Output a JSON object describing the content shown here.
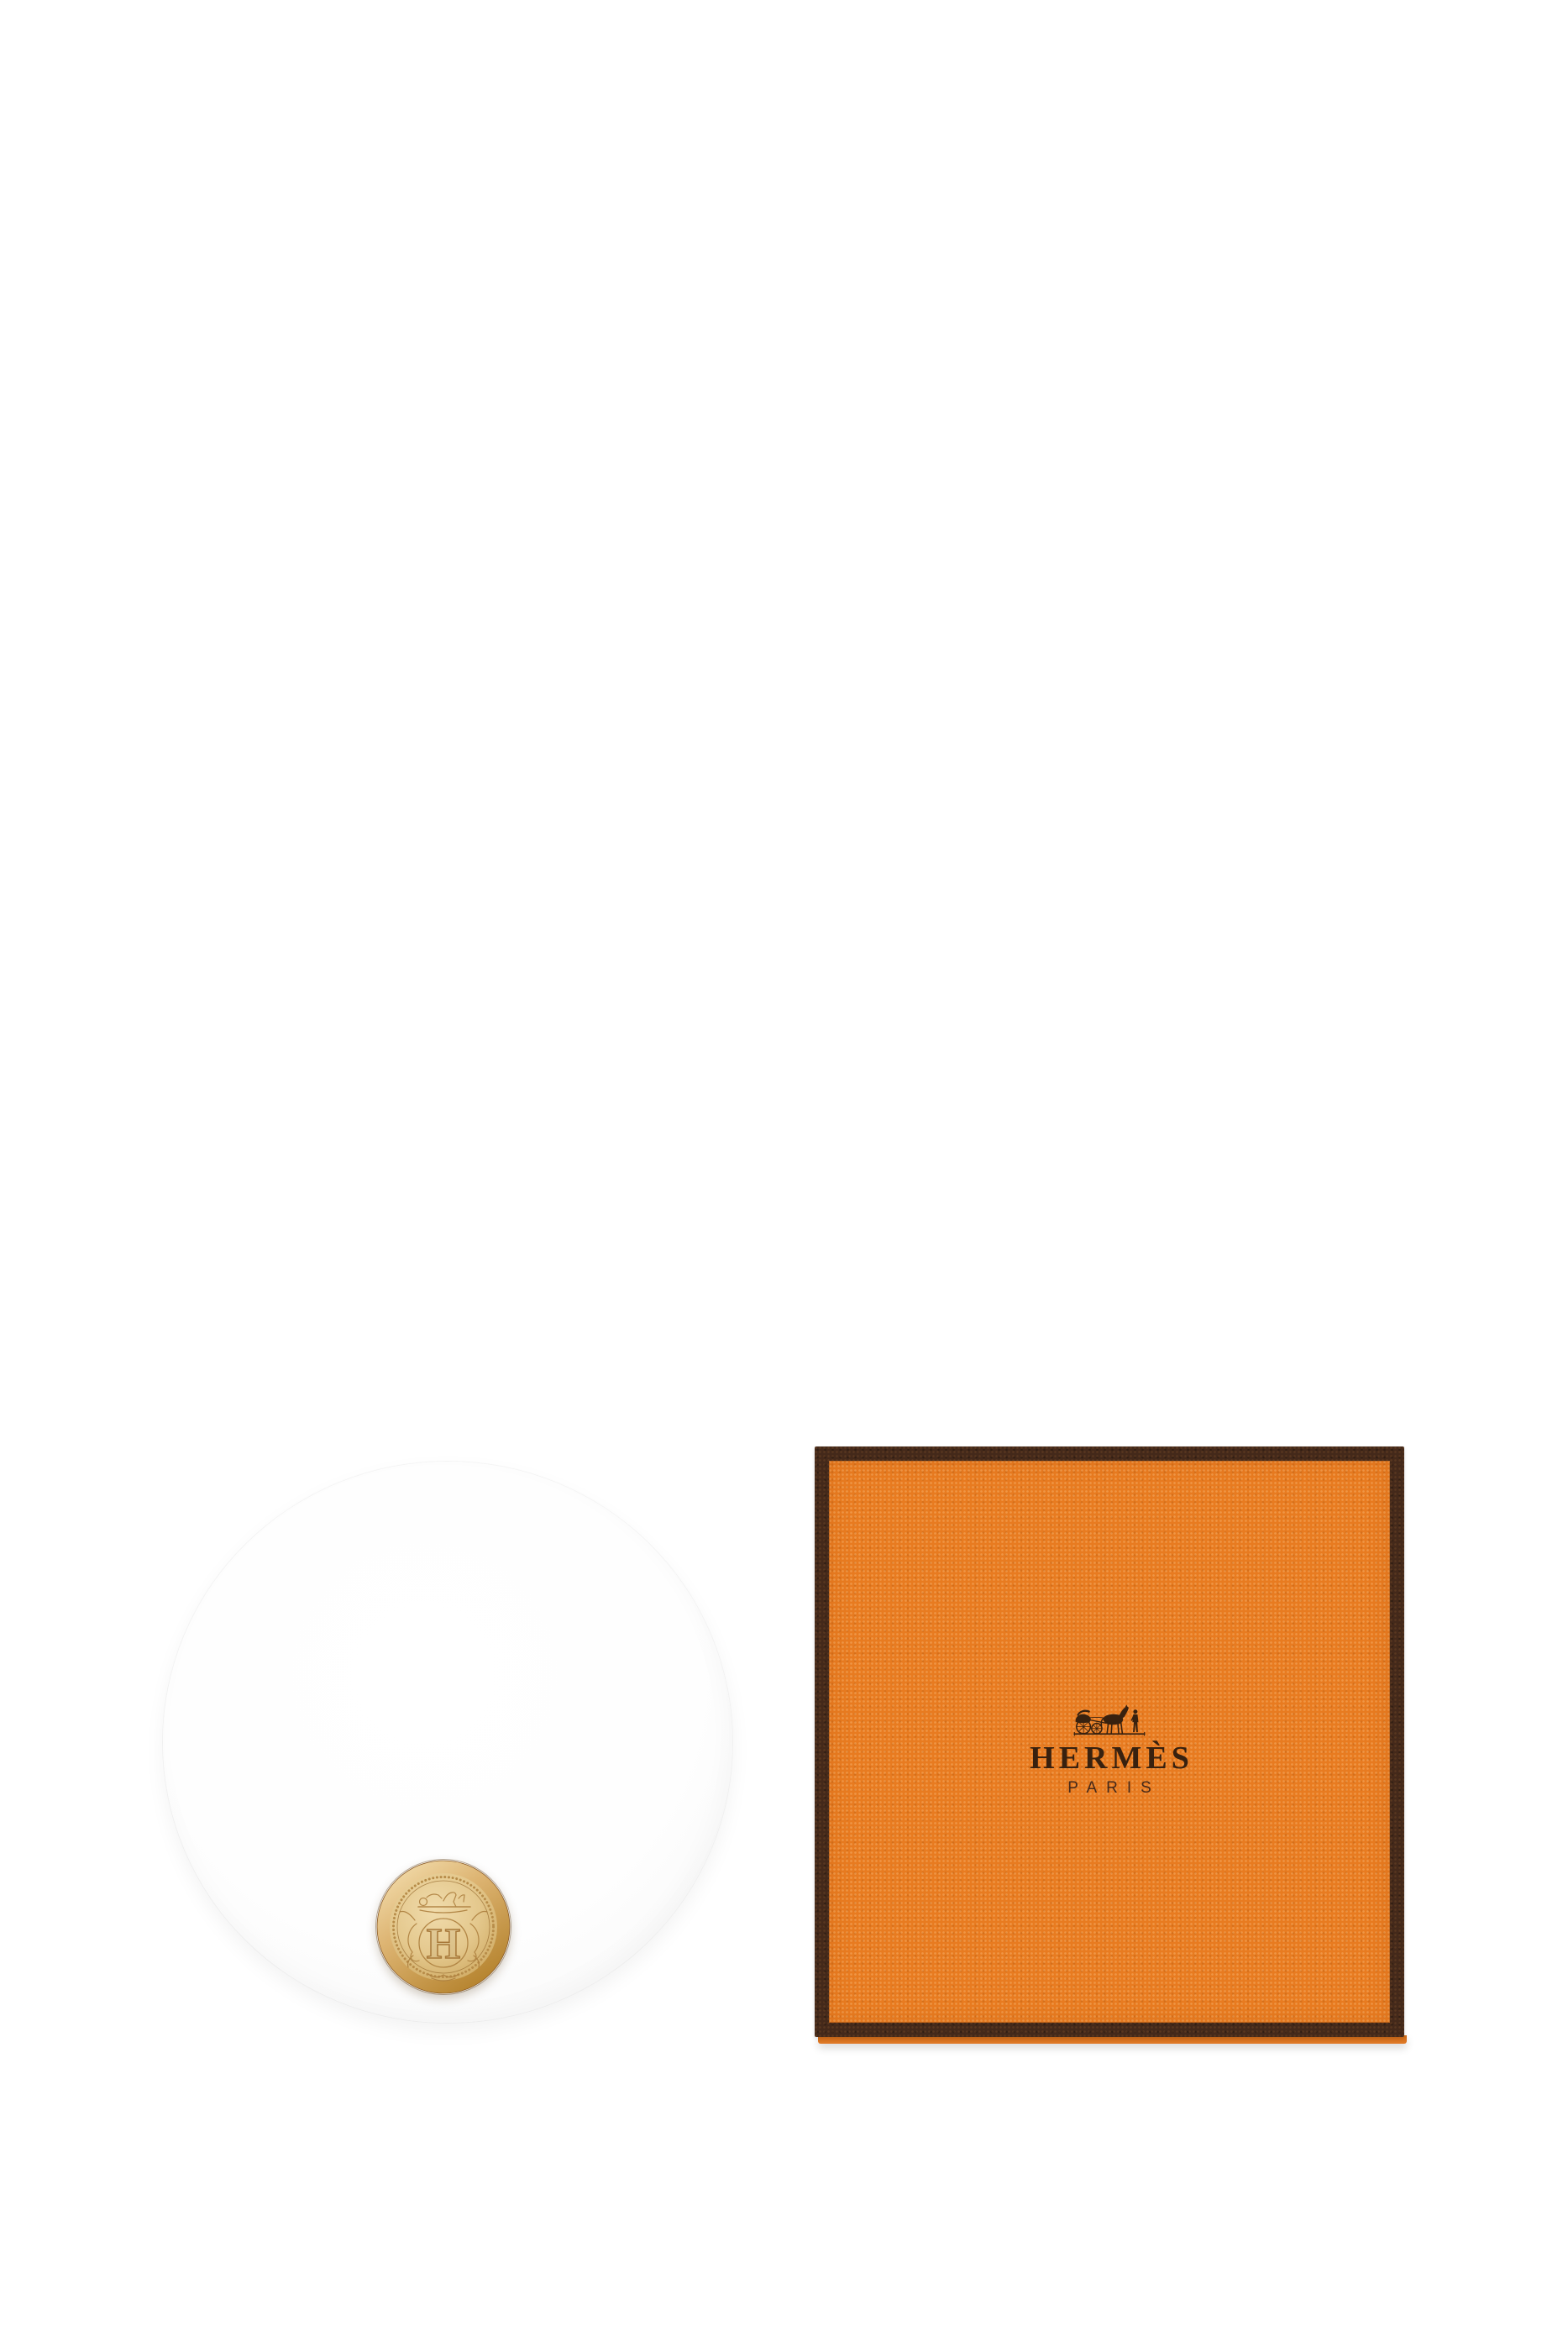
{
  "box": {
    "brand_name": "HERMÈS",
    "city_name": "PARIS",
    "logo_icon": "horse-drawn-carriage-with-groom"
  },
  "compact": {
    "medallion_letter": "H",
    "medallion_icon": "engraved-crest-seal"
  },
  "colors": {
    "page_background": "#ffffff",
    "box_orange": "#e87b20",
    "box_orange_light": "#f59a4a",
    "box_orange_dark": "#cf6a16",
    "box_border_brown": "#44291a",
    "logo_text_brown": "#38210f",
    "medallion_gold_light": "#f3ddae",
    "medallion_gold": "#ddb873",
    "medallion_gold_dark": "#b8862f",
    "disc_white": "#fdfdfd"
  }
}
